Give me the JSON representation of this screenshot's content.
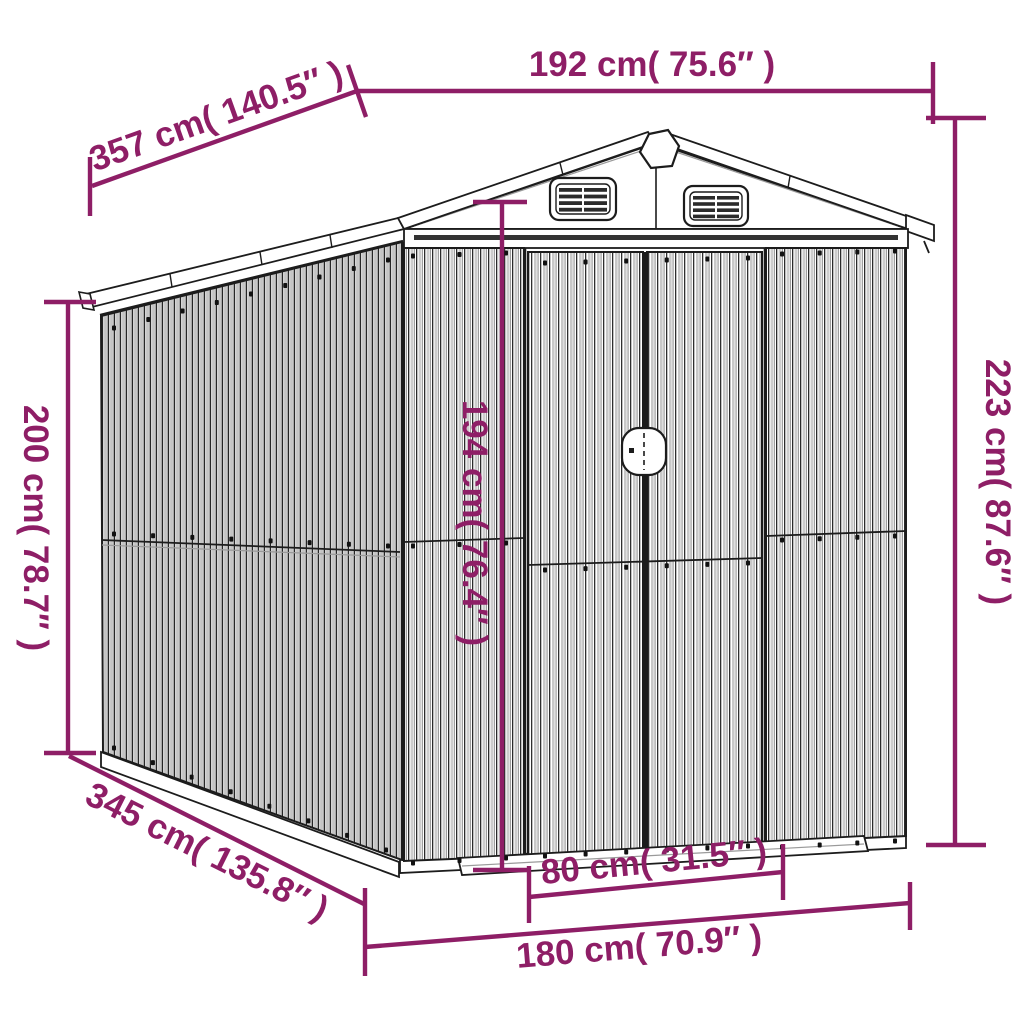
{
  "diagram": {
    "accent_color": "#8e1e66",
    "line_color": "#1c1c1c",
    "subject": "garden-shed-dimension-diagram",
    "dimensions": {
      "roof_width": {
        "label": "192 cm( 75.6″ )"
      },
      "roof_depth": {
        "label": "357 cm( 140.5″ )"
      },
      "wall_height": {
        "label": "200 cm( 78.7″ )"
      },
      "total_height": {
        "label": "223 cm( 87.6″ )"
      },
      "door_height": {
        "label": "194 cm( 76.4″ )"
      },
      "door_width": {
        "label": "80 cm( 31.5″ )"
      },
      "base_width": {
        "label": "180 cm( 70.9″ )"
      },
      "base_depth": {
        "label": "345 cm( 135.8″ )"
      }
    }
  }
}
